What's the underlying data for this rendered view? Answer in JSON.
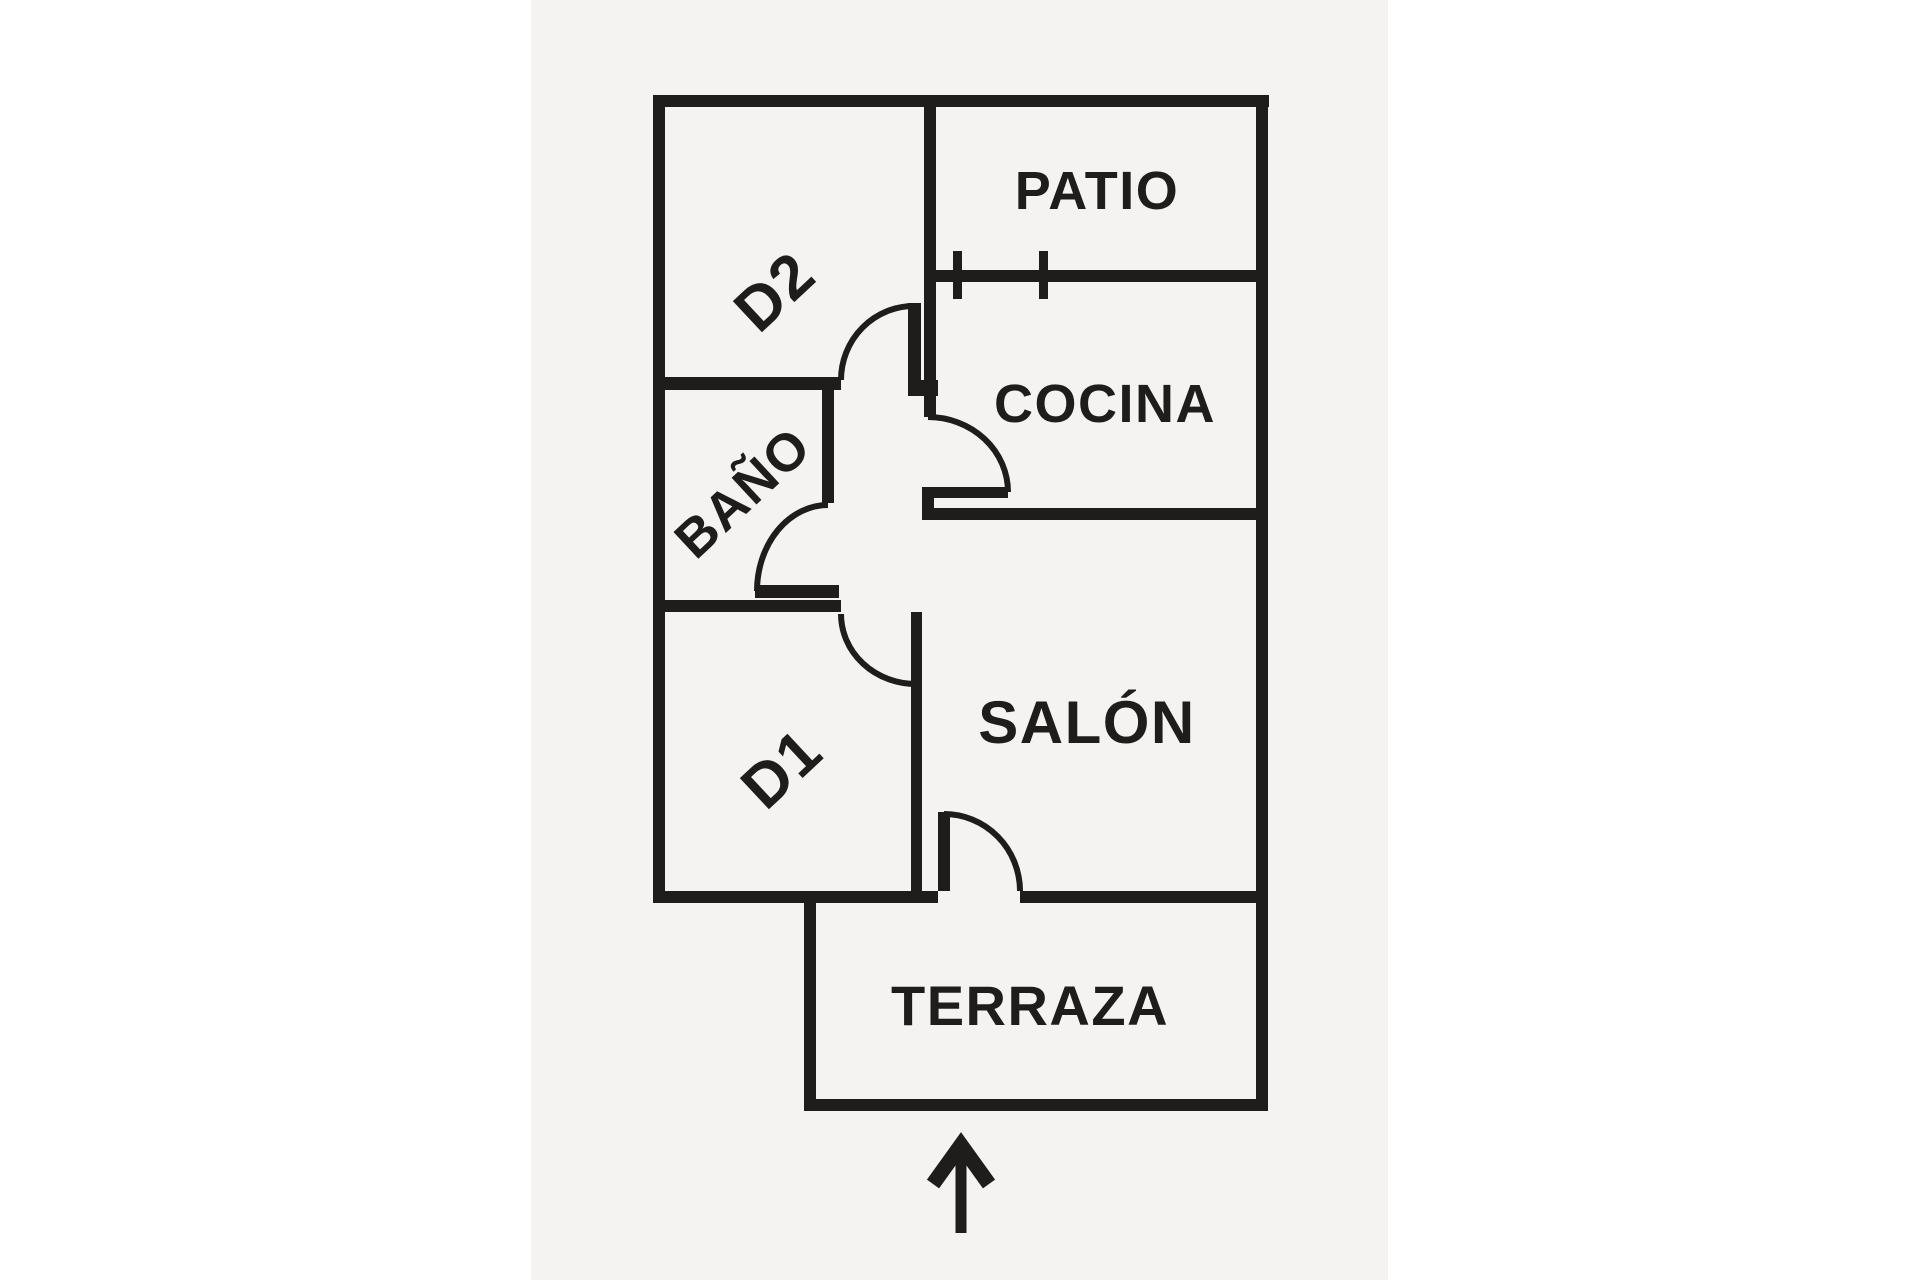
{
  "document": {
    "type": "floor-plan",
    "orientation_arrow": "entrance-up-arrow"
  },
  "colors": {
    "wall": "#1f1d1b",
    "paper": "#f4f3f1",
    "canvas": "#ffffff"
  },
  "rooms": {
    "patio": {
      "label": "PATIO"
    },
    "d2": {
      "label": "D2"
    },
    "cocina": {
      "label": "COCINA"
    },
    "bano": {
      "label": "BAÑO"
    },
    "salon": {
      "label": "SALÓN"
    },
    "d1": {
      "label": "D1"
    },
    "terraza": {
      "label": "TERRAZA"
    }
  },
  "features": {
    "window": "double-tick window symbol on patio/cocina wall",
    "doors": [
      "d2-door",
      "bano-door",
      "cocina-door",
      "d1-door",
      "salon-terraza-door"
    ]
  }
}
